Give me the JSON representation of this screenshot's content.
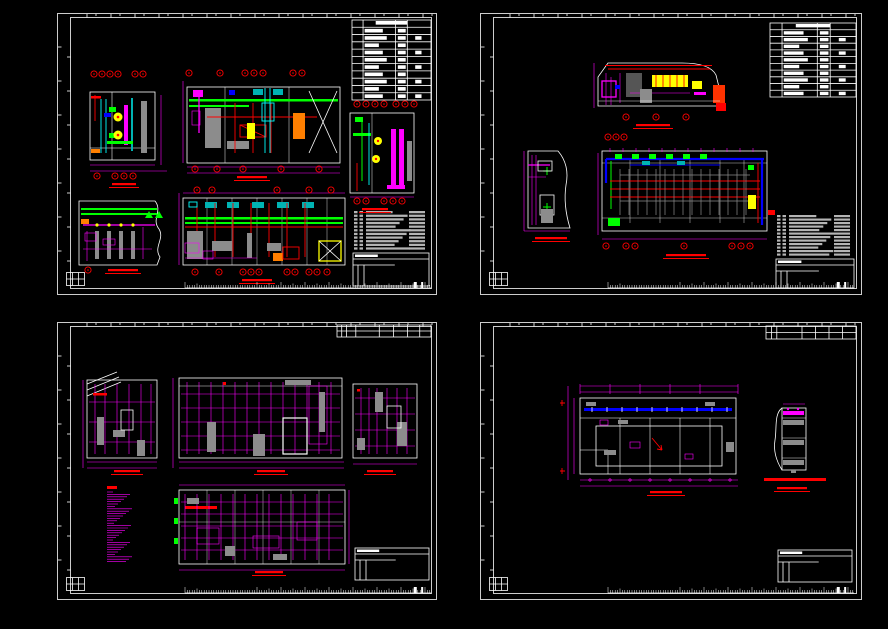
{
  "canvas": {
    "background": "#000000",
    "width": 888,
    "height": 629
  },
  "palette": {
    "frame": "#ffffff",
    "magenta": "#ff00ff",
    "red": "#ff0000",
    "green": "#00ff00",
    "cyan": "#00ffff",
    "blue": "#0000ff",
    "yellow": "#ffff00",
    "orange": "#ff7f00",
    "gray": "#8c8c8c",
    "teal": "#00b3b3",
    "schedule_text": "#b4b4b4",
    "dark_panel": "#555555"
  },
  "sheets": [
    {
      "name": "drawing-sheet-1-top-left",
      "x": 57,
      "y": 13,
      "w": 380,
      "h": 282,
      "gen": {
        "tables": [
          {
            "x": 295,
            "y": 7,
            "w": 79,
            "h": 80,
            "rows": 11,
            "cols": 4,
            "bars": "white"
          }
        ],
        "schedules": [
          {
            "x": 296,
            "y": 198,
            "w": 76,
            "h": 40,
            "rows": 11
          }
        ],
        "titleblocks": [
          {
            "x": 296,
            "y": 240,
            "w": 76,
            "h": 33
          }
        ],
        "dimrows": [
          {
            "x": 37,
            "y": 61,
            "n": 4,
            "dx": 8
          },
          {
            "x": 78,
            "y": 61,
            "n": 2,
            "dx": 8
          },
          {
            "x": 132,
            "y": 60,
            "n": 1
          },
          {
            "x": 163,
            "y": 60,
            "n": 1
          },
          {
            "x": 188,
            "y": 60,
            "n": 3,
            "dx": 9
          },
          {
            "x": 236,
            "y": 60,
            "n": 2,
            "dx": 9
          },
          {
            "x": 300,
            "y": 91,
            "n": 4,
            "dx": 9
          },
          {
            "x": 339,
            "y": 91,
            "n": 3,
            "dx": 9
          },
          {
            "x": 40,
            "y": 163,
            "n": 1
          },
          {
            "x": 58,
            "y": 163,
            "n": 3,
            "dx": 9
          },
          {
            "x": 138,
            "y": 156,
            "n": 1
          },
          {
            "x": 160,
            "y": 156,
            "n": 1
          },
          {
            "x": 186,
            "y": 156,
            "n": 1
          },
          {
            "x": 224,
            "y": 156,
            "n": 1
          },
          {
            "x": 262,
            "y": 156,
            "n": 1
          },
          {
            "x": 300,
            "y": 188,
            "n": 2,
            "dx": 9
          },
          {
            "x": 327,
            "y": 188,
            "n": 3,
            "dx": 9
          },
          {
            "x": 31,
            "y": 257,
            "n": 1
          },
          {
            "x": 140,
            "y": 177,
            "n": 1
          },
          {
            "x": 155,
            "y": 177,
            "n": 1
          },
          {
            "x": 220,
            "y": 177,
            "n": 1
          },
          {
            "x": 252,
            "y": 177,
            "n": 1
          },
          {
            "x": 274,
            "y": 177,
            "n": 1
          },
          {
            "x": 138,
            "y": 259,
            "n": 1
          },
          {
            "x": 162,
            "y": 259,
            "n": 1
          },
          {
            "x": 186,
            "y": 259,
            "n": 3,
            "dx": 8
          },
          {
            "x": 230,
            "y": 259,
            "n": 2,
            "dx": 8
          },
          {
            "x": 252,
            "y": 259,
            "n": 2,
            "dx": 8
          },
          {
            "x": 270,
            "y": 259,
            "n": 1
          }
        ],
        "rlabels": [
          {
            "x": 55,
            "y": 170,
            "w": 24
          },
          {
            "x": 180,
            "y": 163,
            "w": 30
          },
          {
            "x": 305,
            "y": 195,
            "w": 26
          },
          {
            "x": 51,
            "y": 256,
            "w": 30
          },
          {
            "x": 185,
            "y": 266,
            "w": 30
          }
        ],
        "redtexts": [],
        "notes": [],
        "rulers": [
          {
            "x": 128,
            "y": 272,
            "w": 246
          }
        ]
      }
    },
    {
      "name": "drawing-sheet-2-top-right",
      "x": 480,
      "y": 13,
      "w": 382,
      "h": 282,
      "gen": {
        "tables": [
          {
            "x": 290,
            "y": 10,
            "w": 86,
            "h": 74,
            "rows": 11,
            "cols": 4,
            "bars": "white"
          }
        ],
        "schedules": [
          {
            "x": 296,
            "y": 202,
            "w": 78,
            "h": 42,
            "rows": 12
          }
        ],
        "titleblocks": [
          {
            "x": 296,
            "y": 246,
            "w": 78,
            "h": 29
          }
        ],
        "dimrows": [
          {
            "x": 146,
            "y": 104,
            "n": 1
          },
          {
            "x": 176,
            "y": 104,
            "n": 1
          },
          {
            "x": 206,
            "y": 104,
            "n": 1
          },
          {
            "x": 128,
            "y": 124,
            "n": 3,
            "dx": 8
          },
          {
            "x": 126,
            "y": 233,
            "n": 1
          },
          {
            "x": 146,
            "y": 233,
            "n": 2,
            "dx": 9
          },
          {
            "x": 204,
            "y": 233,
            "n": 1
          },
          {
            "x": 252,
            "y": 233,
            "n": 3,
            "dx": 9
          }
        ],
        "rlabels": [
          {
            "x": 156,
            "y": 111,
            "w": 34
          },
          {
            "x": 55,
            "y": 224,
            "w": 32
          },
          {
            "x": 186,
            "y": 241,
            "w": 40
          }
        ],
        "redtexts": [
          {
            "x": 288,
            "y": 197,
            "w": 7,
            "h": 5
          }
        ],
        "notes": [],
        "rulers": [
          {
            "x": 128,
            "y": 272,
            "w": 246
          }
        ]
      }
    },
    {
      "name": "drawing-sheet-3-bottom-left",
      "x": 57,
      "y": 322,
      "w": 380,
      "h": 278,
      "gen": {
        "tables": [
          {
            "x": 280,
            "y": 3,
            "w": 94,
            "h": 12,
            "rows": 2,
            "cols": 8,
            "bars": null
          }
        ],
        "schedules": [],
        "titleblocks": [
          {
            "x": 298,
            "y": 226,
            "w": 74,
            "h": 32
          }
        ],
        "dimrows": [],
        "rlabels": [
          {
            "x": 57,
            "y": 148,
            "w": 26
          },
          {
            "x": 200,
            "y": 148,
            "w": 28
          },
          {
            "x": 310,
            "y": 148,
            "w": 26
          },
          {
            "x": 198,
            "y": 249,
            "w": 28
          }
        ],
        "redtexts": [],
        "notes": [
          {
            "x": 50,
            "y": 164,
            "w": 26,
            "n": 30
          }
        ],
        "rulers": [
          {
            "x": 128,
            "y": 268,
            "w": 246
          }
        ]
      }
    },
    {
      "name": "drawing-sheet-4-bottom-right",
      "x": 480,
      "y": 322,
      "w": 382,
      "h": 278,
      "gen": {
        "tables": [
          {
            "x": 286,
            "y": 4,
            "w": 90,
            "h": 13,
            "rows": 2,
            "cols": 7,
            "bars": null
          }
        ],
        "schedules": [],
        "titleblocks": [
          {
            "x": 298,
            "y": 228,
            "w": 74,
            "h": 32
          }
        ],
        "dimrows": [],
        "rlabels": [
          {
            "x": 170,
            "y": 169,
            "w": 32
          },
          {
            "x": 297,
            "y": 165,
            "w": 30
          }
        ],
        "redtexts": [
          {
            "x": 284,
            "y": 156,
            "w": 62,
            "h": 3
          }
        ],
        "notes": [],
        "rulers": [
          {
            "x": 128,
            "y": 268,
            "w": 246
          }
        ]
      }
    }
  ]
}
